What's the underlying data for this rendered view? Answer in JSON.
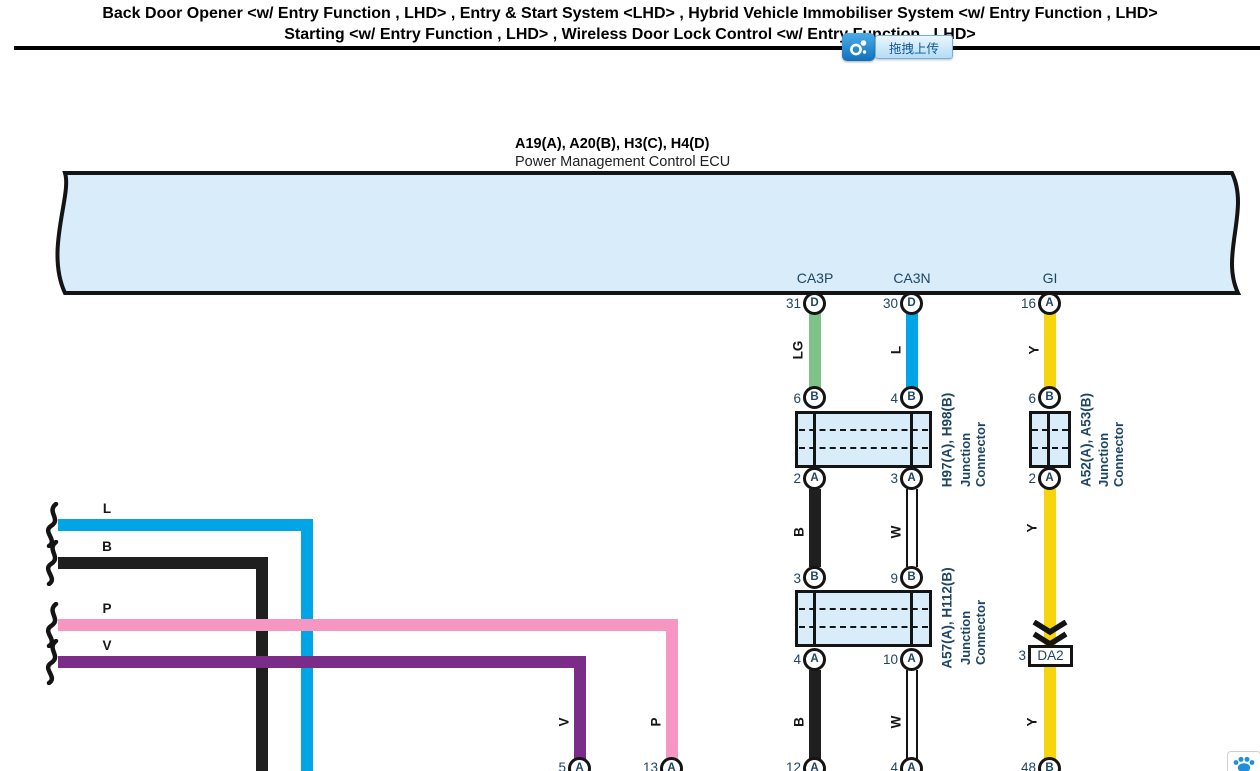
{
  "title": {
    "line1": "Back Door Opener <w/ Entry Function , LHD> , Entry & Start System <LHD> , Hybrid Vehicle Immobiliser System <w/ Entry Function , LHD>",
    "line2": "Starting <w/ Entry Function , LHD> , Wireless Door Lock Control <w/ Entry Function , LHD>"
  },
  "upload": {
    "label": "拖拽上传",
    "icon": "link-nodes-icon"
  },
  "paw_button": {
    "icon": "paw-icon"
  },
  "ecu": {
    "codes": "A19(A), A20(B), H3(C), H4(D)",
    "name": "Power Management Control ECU",
    "connectors": [
      "CA3P",
      "CA3N",
      "GI"
    ],
    "pins": [
      {
        "num": "31",
        "letter": "D"
      },
      {
        "num": "30",
        "letter": "D"
      },
      {
        "num": "16",
        "letter": "A"
      }
    ]
  },
  "junction1": {
    "code": "H97(A), H98(B)",
    "name": "Junction Connector",
    "top_pins": [
      {
        "num": "6",
        "letter": "B"
      },
      {
        "num": "4",
        "letter": "B"
      }
    ],
    "bottom_pins": [
      {
        "num": "2",
        "letter": "A"
      },
      {
        "num": "3",
        "letter": "A"
      }
    ]
  },
  "junction2": {
    "code": "A52(A), A53(B)",
    "name": "Junction Connector",
    "top_pins": [
      {
        "num": "6",
        "letter": "B"
      }
    ],
    "bottom_pins": [
      {
        "num": "2",
        "letter": "A"
      }
    ]
  },
  "junction3": {
    "code": "A57(A), H112(B)",
    "name": "Junction Connector",
    "top_pins": [
      {
        "num": "3",
        "letter": "B"
      },
      {
        "num": "9",
        "letter": "B"
      }
    ],
    "bottom_pins": [
      {
        "num": "4",
        "letter": "A"
      },
      {
        "num": "10",
        "letter": "A"
      }
    ]
  },
  "da2": {
    "num": "3",
    "label": "DA2"
  },
  "bottom_pins": [
    {
      "num": "5",
      "letter": "A"
    },
    {
      "num": "13",
      "letter": "A"
    },
    {
      "num": "12",
      "letter": "A"
    },
    {
      "num": "4",
      "letter": "A"
    },
    {
      "num": "48",
      "letter": "B"
    }
  ],
  "wire_labels": {
    "top": [
      "LG",
      "L",
      "Y"
    ],
    "mid": [
      "B",
      "W",
      "Y"
    ],
    "left": [
      "L",
      "B",
      "P",
      "V"
    ],
    "bottom": [
      "V",
      "P",
      "B",
      "W",
      "Y"
    ]
  },
  "colors": {
    "ecu_fill": "#d8ecf9",
    "outline": "#141414",
    "green": "#7fc287",
    "blue": "#00a5e5",
    "yellow": "#f7d50c",
    "black": "#1f1f1f",
    "white": "#ffffff",
    "pink": "#f596c3",
    "purple": "#7b2c88",
    "text_navy": "#1e4563",
    "upload_blue": "#2a96dd"
  }
}
